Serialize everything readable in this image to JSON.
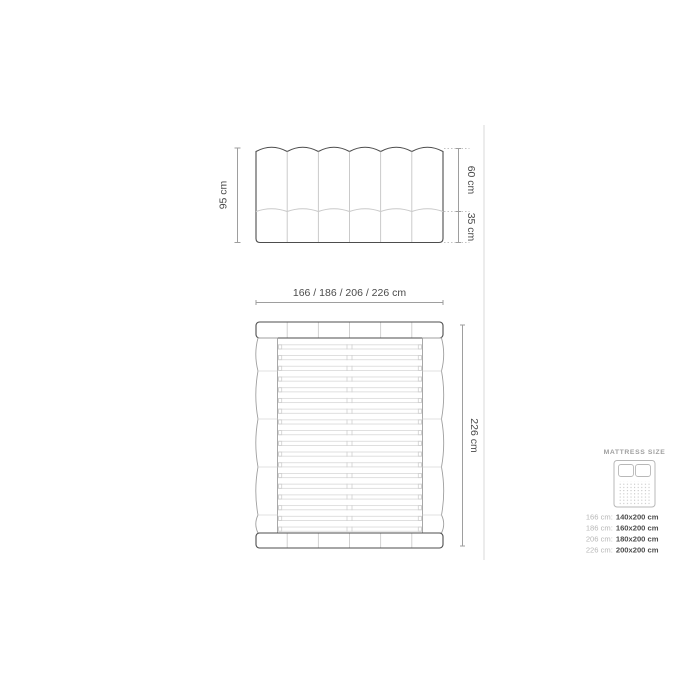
{
  "page": {
    "background": "#ffffff"
  },
  "colors": {
    "outline_dark": "#4d4d4d",
    "dimension_line": "#9e9e9e",
    "line_light": "#c6c6c6",
    "line_faint": "#dadada",
    "legend_gray": "#b7b7b7",
    "text_dark": "#4d4d4d",
    "divider": "#e0e0e0"
  },
  "front_view": {
    "description": "headboard front elevation with 6 vertical channels",
    "channel_count": 6,
    "height_label": "95 cm",
    "upper_section_label": "60 cm",
    "lower_section_label": "35 cm"
  },
  "plan_view": {
    "description": "bed top view with slatted base",
    "width_label": "166 / 186 / 206 / 226 cm",
    "length_label": "226 cm",
    "slat_count": 18,
    "segment_count": 6
  },
  "legend": {
    "title": "MATTRESS SIZE",
    "icon": "mattress-icon",
    "rows": [
      {
        "label": "166 cm:",
        "value": "140x200 cm"
      },
      {
        "label": "186 cm:",
        "value": "160x200 cm"
      },
      {
        "label": "206 cm:",
        "value": "180x200 cm"
      },
      {
        "label": "226 cm:",
        "value": "200x200 cm"
      }
    ]
  }
}
